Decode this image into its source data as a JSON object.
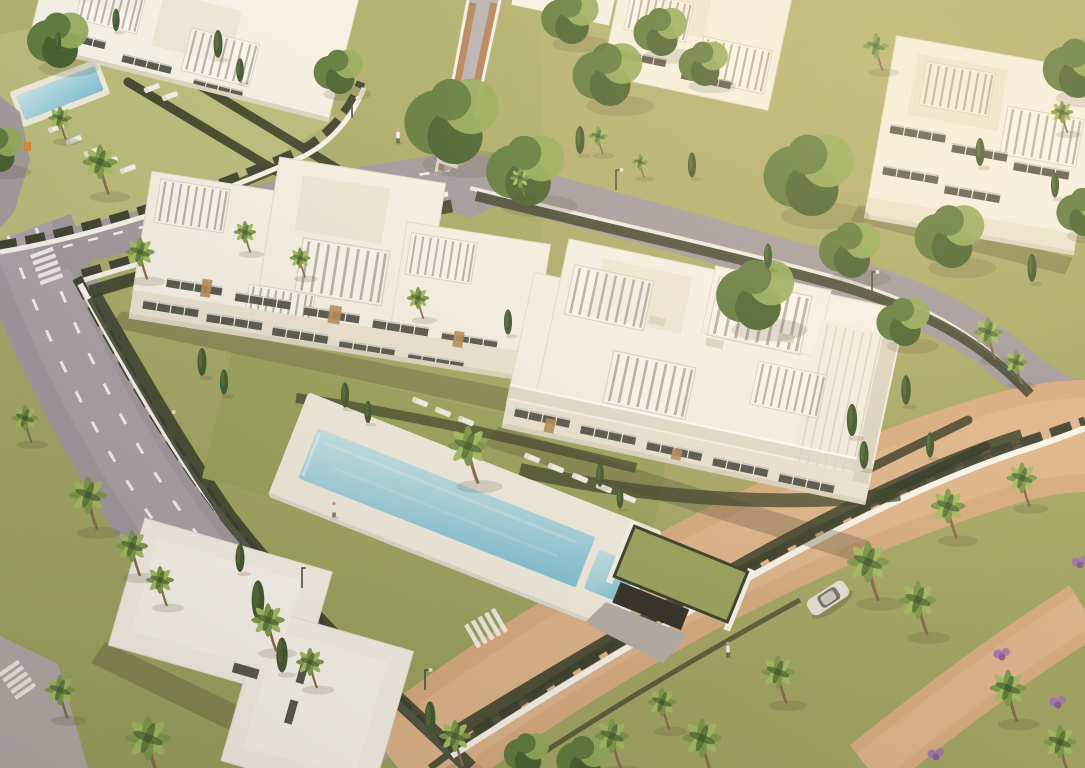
{
  "meta": {
    "title": "Aerial 3D render — modern white apartment complex with pool",
    "description": "Golden-hour aerial visualization of a gated residential development: white multi-storey apartment buildings with roof pergolas and terraces, a long turquoise swimming pool with sun loungers, lawns and hedges, palm and cypress trees, a curving grey road with dashed lane lines and zebra crossings, a brick-paved boulevard with a parked car and walking people.",
    "type": "architectural-visualization",
    "time_of_day": "golden hour"
  },
  "palette": {
    "ground": "#a4a768",
    "lawn": "#9aa35d",
    "lawn_light": "#b9bd7c",
    "lawn_dark": "#7f8c4b",
    "hedge": "#39402a",
    "hedge_dark": "#2c3320",
    "road": "#a29aa0",
    "road_light": "#b7b0b4",
    "road_line": "#f6f4f1",
    "ramp": "#a8948b",
    "brick": "#d7ab80",
    "brick_light": "#e5c09a",
    "wall_white": "#f8f5ed",
    "fence_dark": "#3d4231",
    "building_white": "#f7f3e9",
    "building_cream": "#efe8d9",
    "building_shade": "#ddd5c4",
    "facade_sun": "#ece5d4",
    "window_dark": "#55564c",
    "wood": "#b78a5a",
    "pool_shallow": "#c9e6ec",
    "pool_deep": "#7fc0d6",
    "pool_deck": "#f3eee1",
    "tree": "#5e7a3e",
    "tree_light": "#93ac5c",
    "tree_dark": "#46602f",
    "cypress": "#3f5831",
    "palm": "#7d9a4a",
    "palm_light": "#a4bc62",
    "palm_trunk": "#8a6b4a",
    "shadow": "rgba(70,60,45,0.28)",
    "shadow_soft": "rgba(70,60,45,0.16)",
    "car_body": "#e6e2d8",
    "car_glass": "#5a5f58",
    "flower": "#a277ad",
    "sign_orange": "#d98b3e",
    "person_shirt": "#f2f1ec",
    "person_dark": "#4a4540"
  },
  "scene": {
    "road_dash": "12 22",
    "car_transform": "translate(828 598) rotate(-33)",
    "trees": [
      {
        "x": 455,
        "y": 118,
        "s": 2.3
      },
      {
        "x": 528,
        "y": 168,
        "s": 1.9
      },
      {
        "x": 610,
        "y": 72,
        "s": 1.7
      },
      {
        "x": 572,
        "y": 16,
        "s": 1.4
      },
      {
        "x": 662,
        "y": 30,
        "s": 1.3
      },
      {
        "x": 705,
        "y": 62,
        "s": 1.2
      },
      {
        "x": 812,
        "y": 172,
        "s": 2.2
      },
      {
        "x": 758,
        "y": 292,
        "s": 1.9
      },
      {
        "x": 852,
        "y": 248,
        "s": 1.5
      },
      {
        "x": 952,
        "y": 234,
        "s": 1.7
      },
      {
        "x": 905,
        "y": 320,
        "s": 1.3
      },
      {
        "x": 60,
        "y": 38,
        "s": 1.5
      },
      {
        "x": 0,
        "y": 148,
        "s": 1.2
      },
      {
        "x": 1078,
        "y": 66,
        "s": 1.6
      },
      {
        "x": 1085,
        "y": 210,
        "s": 1.3
      },
      {
        "x": 585,
        "y": 758,
        "s": 1.3
      },
      {
        "x": 528,
        "y": 752,
        "s": 1.1
      },
      {
        "x": 340,
        "y": 70,
        "s": 1.2
      }
    ],
    "cypresses": [
      {
        "x": 218,
        "y": 44,
        "s": 1.0
      },
      {
        "x": 240,
        "y": 70,
        "s": 0.85
      },
      {
        "x": 202,
        "y": 362,
        "s": 1.0
      },
      {
        "x": 224,
        "y": 382,
        "s": 0.9
      },
      {
        "x": 508,
        "y": 322,
        "s": 0.9
      },
      {
        "x": 852,
        "y": 420,
        "s": 1.15
      },
      {
        "x": 864,
        "y": 455,
        "s": 1.0
      },
      {
        "x": 906,
        "y": 390,
        "s": 1.05
      },
      {
        "x": 930,
        "y": 445,
        "s": 0.9
      },
      {
        "x": 768,
        "y": 256,
        "s": 0.9
      },
      {
        "x": 240,
        "y": 558,
        "s": 1.0
      },
      {
        "x": 258,
        "y": 600,
        "s": 1.4
      },
      {
        "x": 282,
        "y": 655,
        "s": 1.25
      },
      {
        "x": 430,
        "y": 718,
        "s": 1.2
      },
      {
        "x": 580,
        "y": 140,
        "s": 1.0
      },
      {
        "x": 692,
        "y": 165,
        "s": 0.9
      },
      {
        "x": 980,
        "y": 152,
        "s": 1.0
      },
      {
        "x": 1032,
        "y": 268,
        "s": 1.0
      },
      {
        "x": 1055,
        "y": 185,
        "s": 0.9
      },
      {
        "x": 116,
        "y": 20,
        "s": 0.8
      },
      {
        "x": 58,
        "y": 42,
        "s": 0.7
      },
      {
        "x": 345,
        "y": 395,
        "s": 0.9
      },
      {
        "x": 368,
        "y": 412,
        "s": 0.8
      },
      {
        "x": 600,
        "y": 475,
        "s": 0.85
      },
      {
        "x": 620,
        "y": 498,
        "s": 0.75
      }
    ],
    "palms": [
      {
        "x": 100,
        "y": 162,
        "s": 1.25
      },
      {
        "x": 60,
        "y": 118,
        "s": 0.85
      },
      {
        "x": 140,
        "y": 252,
        "s": 1.05
      },
      {
        "x": 245,
        "y": 232,
        "s": 0.8
      },
      {
        "x": 300,
        "y": 258,
        "s": 0.75
      },
      {
        "x": 418,
        "y": 298,
        "s": 0.8
      },
      {
        "x": 520,
        "y": 178,
        "s": 0.7
      },
      {
        "x": 468,
        "y": 446,
        "s": 1.45
      },
      {
        "x": 25,
        "y": 418,
        "s": 0.95
      },
      {
        "x": 88,
        "y": 495,
        "s": 1.35
      },
      {
        "x": 132,
        "y": 546,
        "s": 1.15
      },
      {
        "x": 160,
        "y": 580,
        "s": 1.0
      },
      {
        "x": 148,
        "y": 738,
        "s": 1.6
      },
      {
        "x": 60,
        "y": 690,
        "s": 1.1
      },
      {
        "x": 268,
        "y": 620,
        "s": 1.2
      },
      {
        "x": 310,
        "y": 662,
        "s": 1.0
      },
      {
        "x": 455,
        "y": 736,
        "s": 1.15
      },
      {
        "x": 612,
        "y": 736,
        "s": 1.25
      },
      {
        "x": 662,
        "y": 702,
        "s": 1.05
      },
      {
        "x": 702,
        "y": 738,
        "s": 1.4
      },
      {
        "x": 778,
        "y": 672,
        "s": 1.2
      },
      {
        "x": 868,
        "y": 562,
        "s": 1.5
      },
      {
        "x": 948,
        "y": 506,
        "s": 1.25
      },
      {
        "x": 918,
        "y": 600,
        "s": 1.35
      },
      {
        "x": 1008,
        "y": 688,
        "s": 1.3
      },
      {
        "x": 1060,
        "y": 742,
        "s": 1.2
      },
      {
        "x": 1022,
        "y": 478,
        "s": 1.1
      },
      {
        "x": 988,
        "y": 332,
        "s": 1.05
      },
      {
        "x": 1016,
        "y": 362,
        "s": 0.85
      },
      {
        "x": 876,
        "y": 46,
        "s": 0.95
      },
      {
        "x": 1062,
        "y": 112,
        "s": 0.8
      },
      {
        "x": 598,
        "y": 136,
        "s": 0.7
      },
      {
        "x": 640,
        "y": 162,
        "s": 0.6
      }
    ],
    "loungers": [
      {
        "x": 56,
        "y": 128,
        "r": -20
      },
      {
        "x": 74,
        "y": 140,
        "r": -20
      },
      {
        "x": 92,
        "y": 152,
        "r": -20
      },
      {
        "x": 110,
        "y": 161,
        "r": -20
      },
      {
        "x": 128,
        "y": 169,
        "r": -20
      },
      {
        "x": 152,
        "y": 88,
        "r": -20
      },
      {
        "x": 170,
        "y": 96,
        "r": -20
      },
      {
        "x": 420,
        "y": 402,
        "r": 22
      },
      {
        "x": 443,
        "y": 412,
        "r": 22
      },
      {
        "x": 466,
        "y": 421,
        "r": 22
      },
      {
        "x": 532,
        "y": 458,
        "r": 22
      },
      {
        "x": 556,
        "y": 468,
        "r": 22
      },
      {
        "x": 580,
        "y": 478,
        "r": 22
      },
      {
        "x": 604,
        "y": 488,
        "r": 22
      },
      {
        "x": 628,
        "y": 498,
        "r": 22
      }
    ],
    "crosswalks": [
      {
        "x": 46,
        "y": 264,
        "r": -20,
        "s": 1.0
      },
      {
        "x": 16,
        "y": 678,
        "r": -35,
        "s": 1.0
      },
      {
        "x": 488,
        "y": 627,
        "r": 60,
        "s": 1.1
      },
      {
        "x": 452,
        "y": 150,
        "r": 18,
        "s": 0.9
      }
    ],
    "lamps": [
      {
        "x": 352,
        "y": 118
      },
      {
        "x": 616,
        "y": 190
      },
      {
        "x": 872,
        "y": 292
      },
      {
        "x": 168,
        "y": 432
      },
      {
        "x": 302,
        "y": 588
      },
      {
        "x": 425,
        "y": 690
      }
    ],
    "people": [
      {
        "x": 334,
        "y": 512
      },
      {
        "x": 728,
        "y": 652
      },
      {
        "x": 398,
        "y": 138
      }
    ],
    "flowers": [
      {
        "x": 1002,
        "y": 652
      },
      {
        "x": 1058,
        "y": 700
      },
      {
        "x": 936,
        "y": 752
      },
      {
        "x": 1080,
        "y": 560
      }
    ]
  }
}
